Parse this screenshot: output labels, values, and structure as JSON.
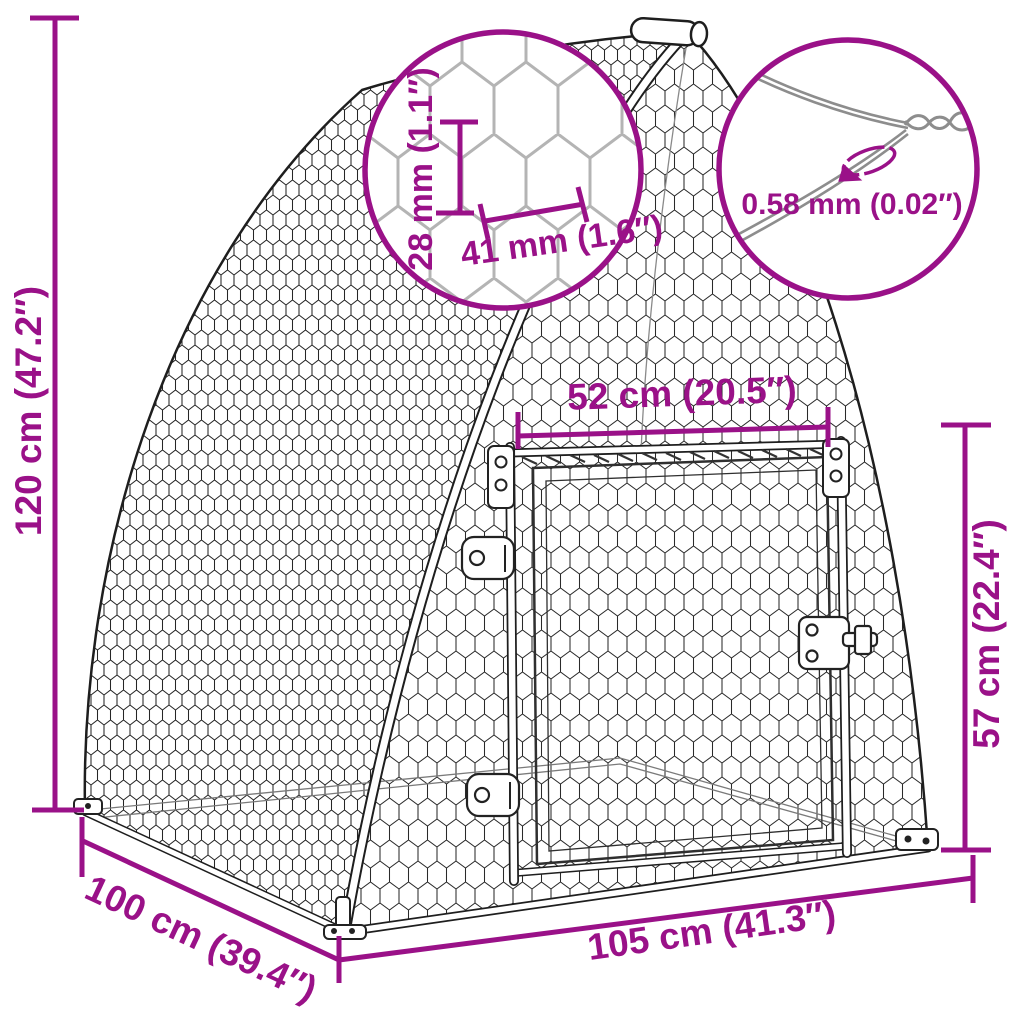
{
  "diagram": {
    "background": "#ffffff",
    "accent_color": "#9A1188",
    "line_color": "#1e1e1e",
    "mesh_detail_gray": "#b4b4b4",
    "wire_gray": "#8d8d8d",
    "labels": {
      "overall_height": "120 cm (47.2″)",
      "base_depth": "100 cm (39.4″)",
      "base_width": "105 cm (41.3″)",
      "door_width": "52 cm (20.5″)",
      "door_height": "57 cm (22.4″)",
      "mesh_cell_height": "28 mm (1.1″)",
      "mesh_cell_width": "41 mm (1.6″)",
      "wire_thickness": "0.58 mm (0.02″)"
    },
    "icons": {
      "rotation_icon": "rotation-ellipse-arrow-icon"
    }
  }
}
